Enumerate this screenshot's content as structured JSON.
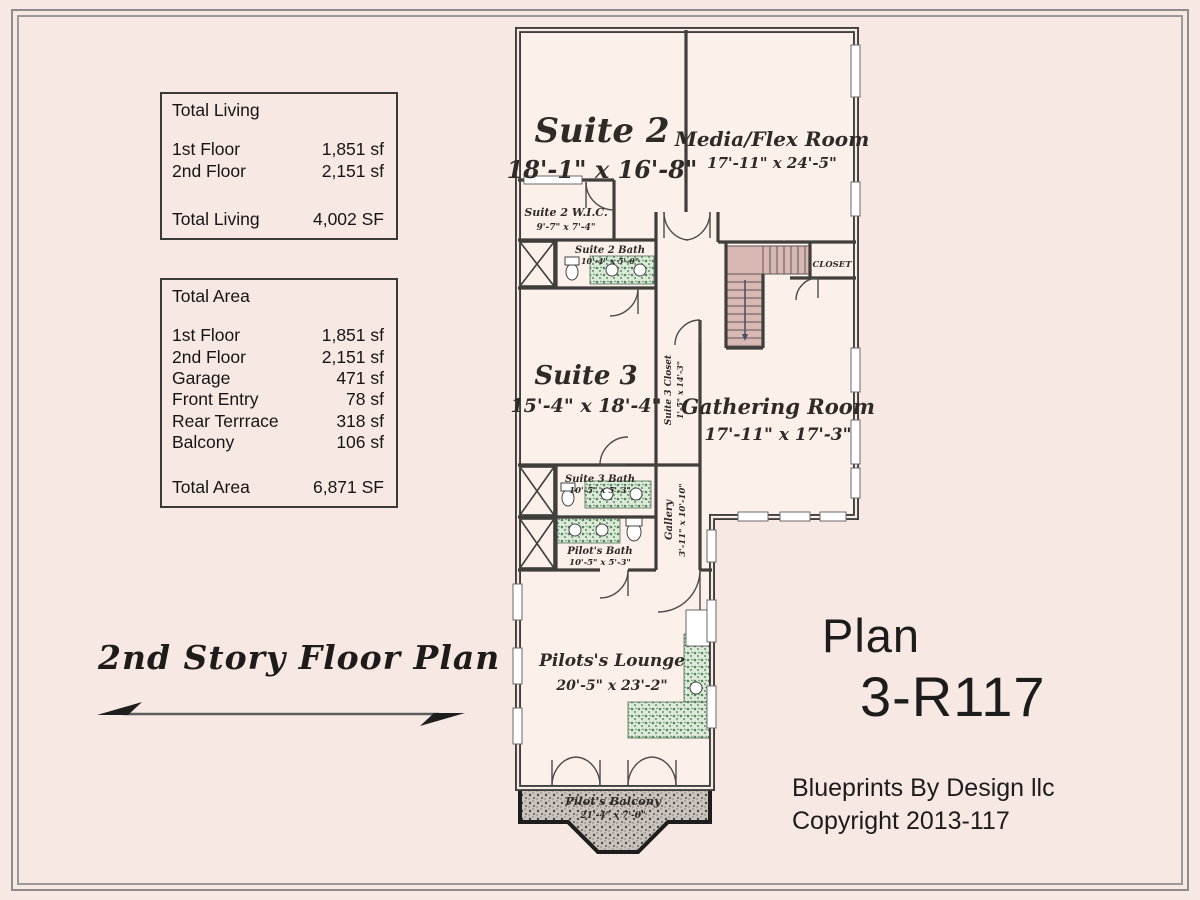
{
  "titles": {
    "plan_title": "2nd Story Floor Plan",
    "plan_label": "Plan",
    "plan_number": "3-R117",
    "credit_line1": "Blueprints By Design llc",
    "credit_line2": "Copyright 2013-117"
  },
  "tables": {
    "living": {
      "title": "Total Living",
      "rows": [
        [
          "1st Floor",
          "1,851 sf"
        ],
        [
          "2nd Floor",
          "2,151 sf"
        ]
      ],
      "total": [
        "Total Living",
        "4,002 SF"
      ]
    },
    "area": {
      "title": "Total Area",
      "rows": [
        [
          "1st Floor",
          "1,851 sf"
        ],
        [
          "2nd Floor",
          "2,151 sf"
        ],
        [
          "Garage",
          "471 sf"
        ],
        [
          "Front Entry",
          "78 sf"
        ],
        [
          "Rear Terrrace",
          "318 sf"
        ],
        [
          "Balcony",
          "106 sf"
        ]
      ],
      "total": [
        "Total Area",
        "6,871 SF"
      ]
    }
  },
  "rooms": {
    "suite2": {
      "name": "Suite 2",
      "dims": "18'-1\" x 16'-8\""
    },
    "media": {
      "name": "Media/Flex Room",
      "dims": "17'-11\" x 24'-5\""
    },
    "wic2": {
      "name": "Suite 2 W.I.C.",
      "dims": "9'-7\" x 7'-4\""
    },
    "bath2": {
      "name": "Suite 2 Bath",
      "dims": "10'-4\" x 5'-0\""
    },
    "closet": {
      "name": "CLOSET",
      "dims": ""
    },
    "suite3": {
      "name": "Suite 3",
      "dims": "15'-4\" x 18'-4\""
    },
    "closet3": {
      "name": "Suite 3 Closet",
      "dims": "1'-5\" x 14'-3\""
    },
    "gathering": {
      "name": "Gathering Room",
      "dims": "17'-11\" x 17'-3\""
    },
    "bath3": {
      "name": "Suite 3 Bath",
      "dims": "10'-5\" x 5'-3\""
    },
    "pilotbath": {
      "name": "Pilot's Bath",
      "dims": "10'-5\" x 5'-3\""
    },
    "gallery": {
      "name": "Gallery",
      "dims": "3'-11\" x 10'-10\""
    },
    "lounge": {
      "name": "Pilots's Lounge",
      "dims": "20'-5\" x 23'-2\""
    },
    "balcony": {
      "name": "Pilot's Balcony",
      "dims": "21'-4\" x 7'-0\""
    }
  },
  "colors": {
    "background": "#f8e8e3",
    "room_fill": "#fcf0ea",
    "wall": "#3f3e3c",
    "stair_fill": "#d9b7b3",
    "counter_green": "#5e9268",
    "balcony_gray": "#cac2bc",
    "frame": "#8d8d8d"
  }
}
